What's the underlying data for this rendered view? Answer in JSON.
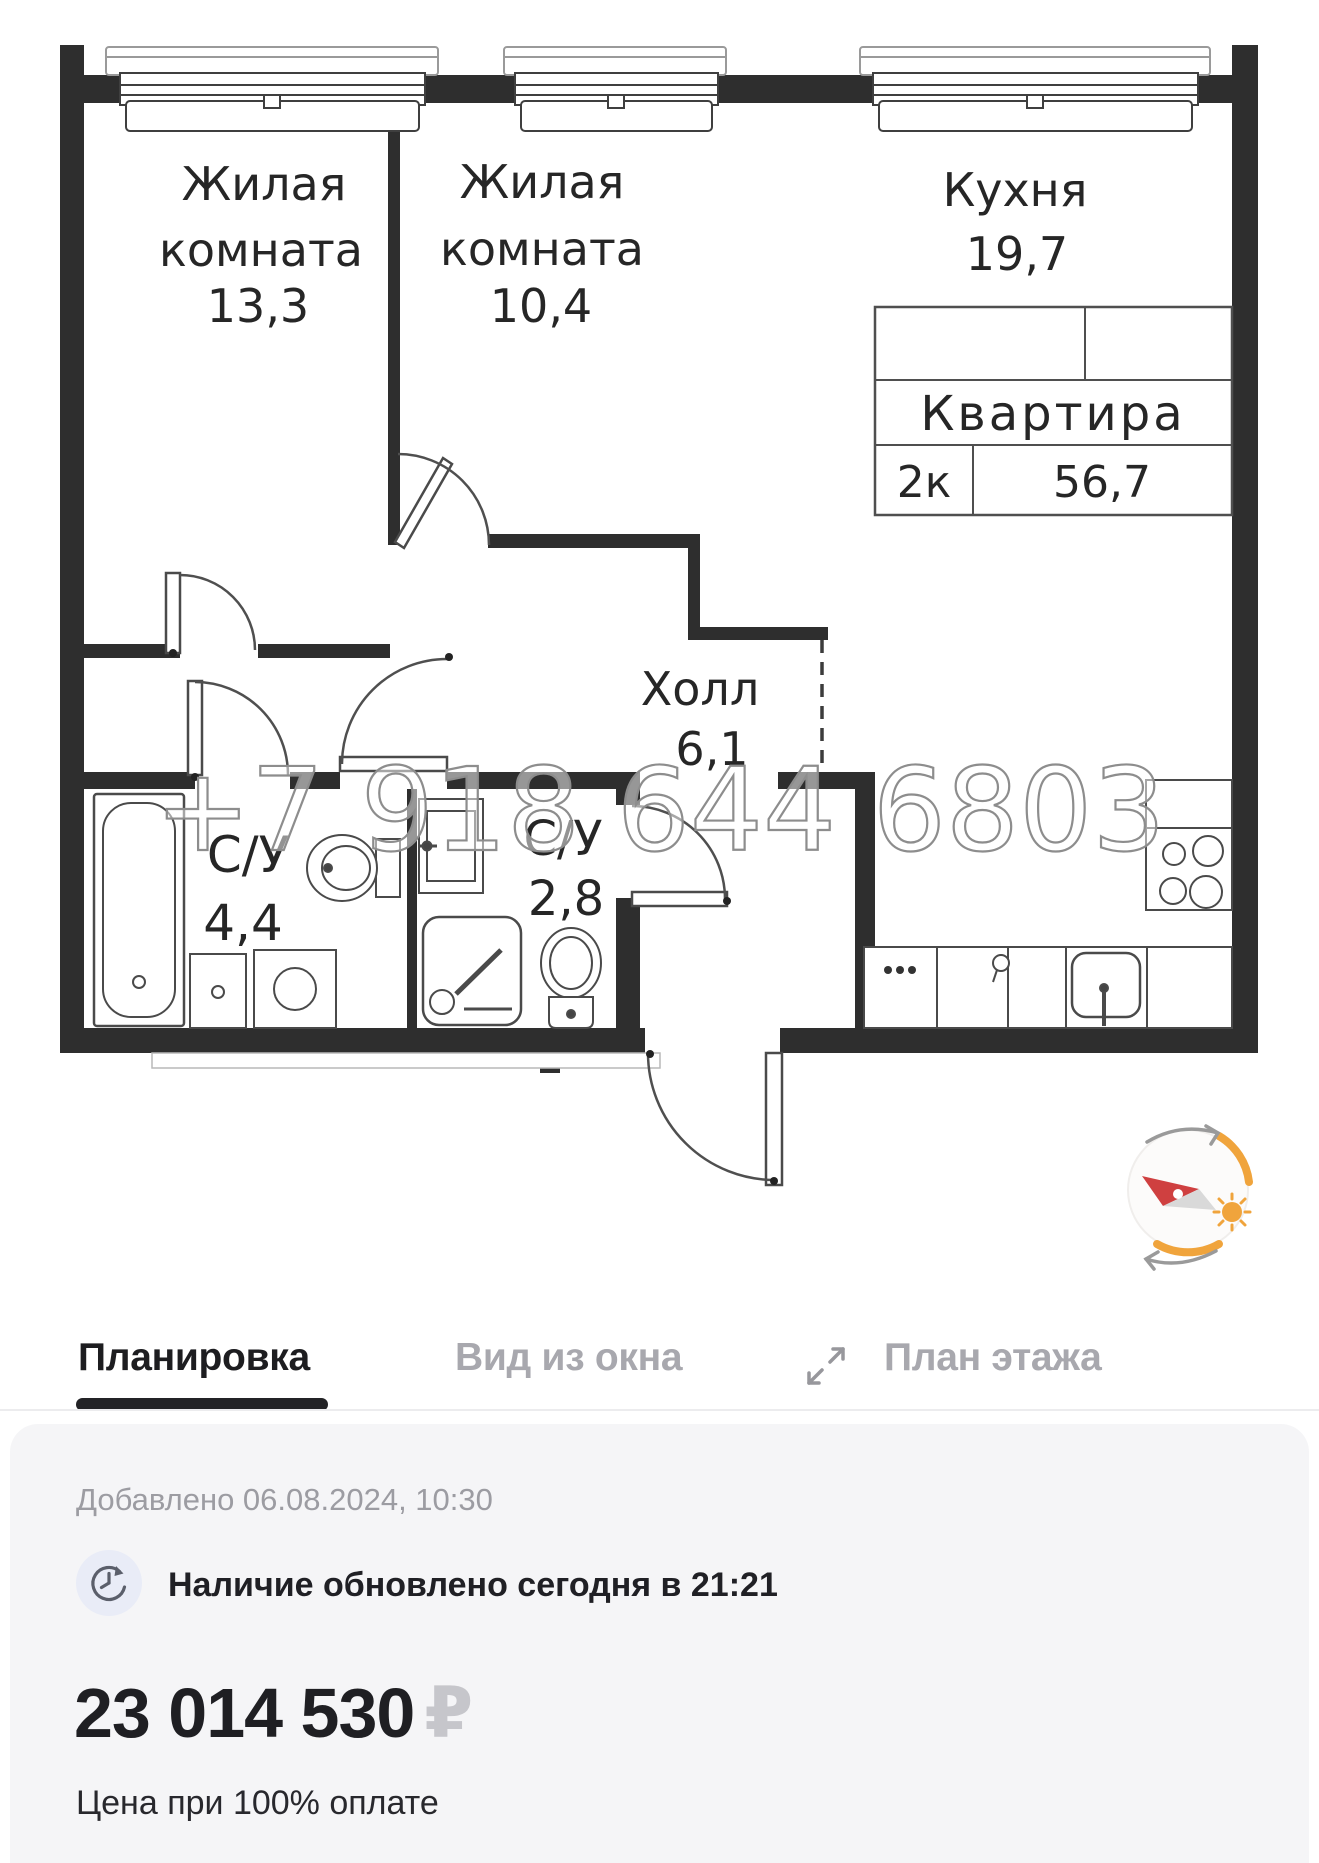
{
  "plan": {
    "watermark": "+7 918 644 6803",
    "room1": {
      "line1": "Жилая",
      "line2": "комната",
      "area": "13,3"
    },
    "room2": {
      "line1": "Жилая",
      "line2": "комната",
      "area": "10,4"
    },
    "kitchen": {
      "label": "Кухня",
      "area": "19,7"
    },
    "hall": {
      "label": "Холл",
      "area": "6,1"
    },
    "bath1": {
      "label": "С/У",
      "area": "4,4"
    },
    "bath2": {
      "label": "С/У",
      "area": "2,8"
    },
    "table": {
      "title": "Квартира",
      "rooms": "2к",
      "area": "56,7"
    }
  },
  "tabs": {
    "items": [
      {
        "label": "Планировка",
        "active": true
      },
      {
        "label": "Вид из окна",
        "active": false
      },
      {
        "label": "План этажа",
        "active": false
      }
    ]
  },
  "icons": {
    "expand": "diagonal-resize-arrows",
    "clock": "clock-refresh",
    "compass": "compass-needle-with-sun"
  },
  "card": {
    "added": "Добавлено 06.08.2024, 10:30",
    "availability": "Наличие обновлено сегодня в 21:21",
    "price": "23 014 530",
    "currency": "₽",
    "price_note": "Цена при 100% оплате"
  },
  "colors": {
    "wall": "#2e2e2e",
    "card_bg": "#f5f5f7",
    "tab_active": "#1d1d20",
    "tab_inactive": "#a8a8ae",
    "accent_red": "#cf4040",
    "accent_orange": "#f0a43c",
    "icon_bg": "#e9ecf7",
    "ruble_sign": "#c6c6cb"
  }
}
